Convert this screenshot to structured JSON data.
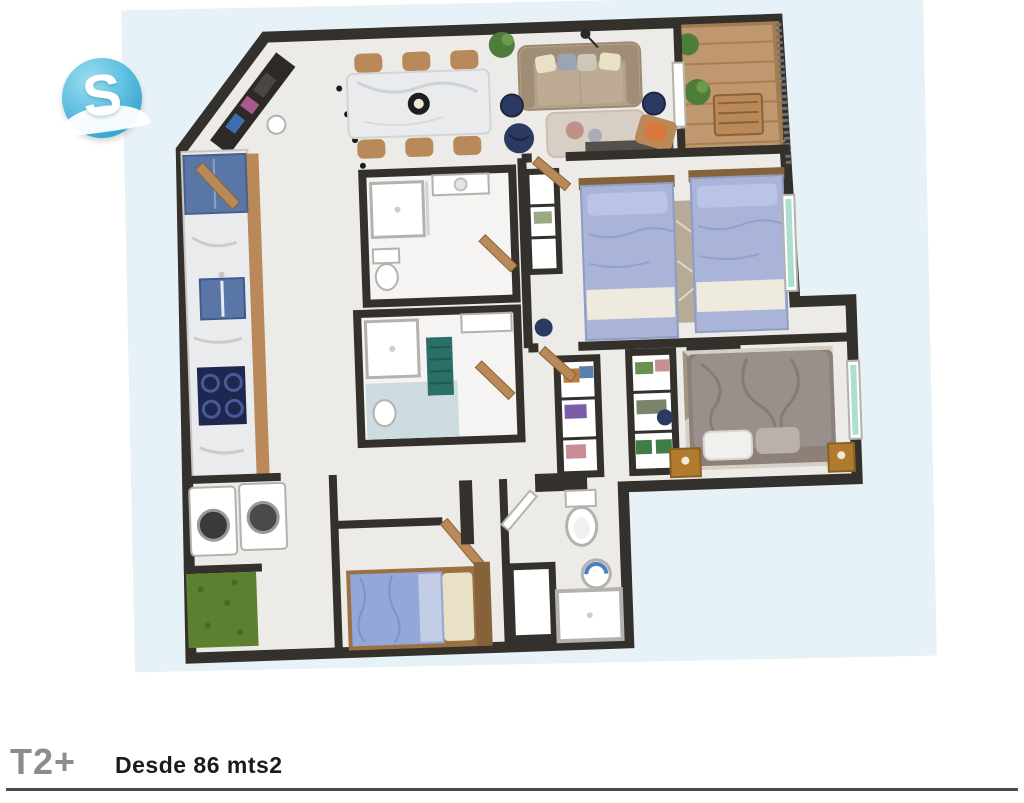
{
  "logo": {
    "letter": "S"
  },
  "icons": {
    "entrance_arrow": "→",
    "logo_sphere": "sphere-logo-icon"
  },
  "footer": {
    "type_label": "T2+",
    "area_label": "Desde 86 mts2"
  },
  "colors": {
    "page_bg": "#ffffff",
    "plan_bg": "#e7f1f8",
    "wall": "#34302c",
    "floor": "#ecebe7",
    "floor_warm": "#f5f4f2",
    "wood": "#b9895a",
    "wood_dark": "#86623a",
    "marble": "#e9ebec",
    "kitchen_blue": "#5a76a6",
    "navy": "#2c3a63",
    "cooktop": "#1d2750",
    "sofa": "#b3a189",
    "sofa_dark": "#a08d75",
    "orange": "#d9783c",
    "lavender": "#a9b4d8",
    "lavender_dark": "#8f9cc4",
    "duvet": "#99908b",
    "cream": "#e9e1c6",
    "turf": "#5d8030",
    "teal": "#2a6f68",
    "glass": "#abdfd0",
    "rug": "#d7cfc3",
    "rug_dark": "#b7ab97",
    "plant": "#4e7d3a",
    "white": "#ffffff",
    "gray_line": "#b5b2ae",
    "blue_floor": "#ccdce1",
    "logo_blue": "#5fc0e1",
    "logo_blue_deep": "#2f9cc6",
    "arrow": "#999999",
    "type_text": "#8c8c8c",
    "text_dark": "#1b1b1b",
    "rule": "#4b4b4b"
  }
}
